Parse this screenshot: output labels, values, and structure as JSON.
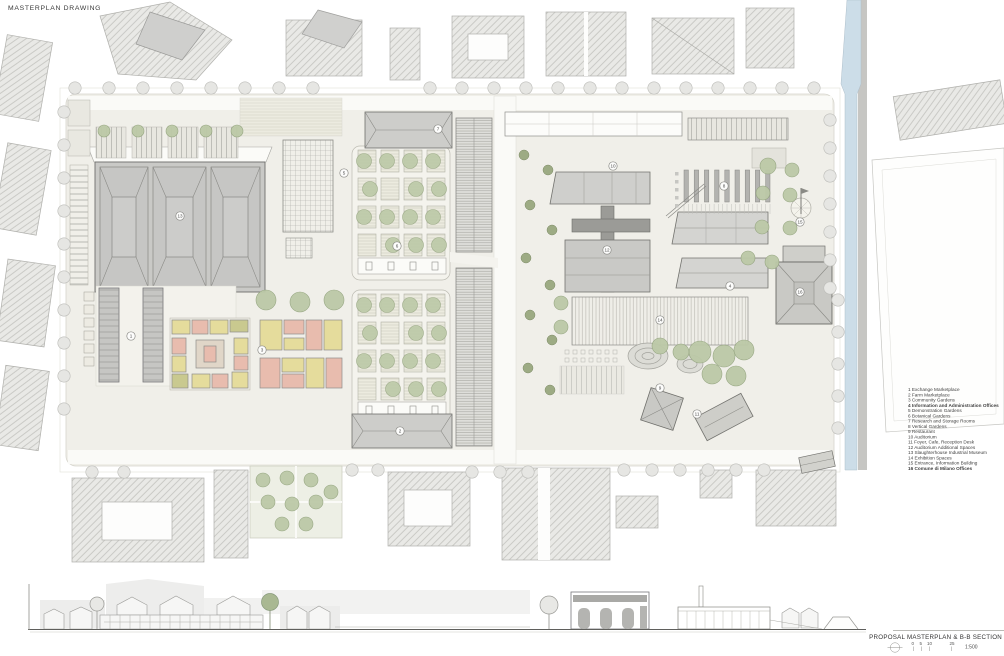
{
  "title": "MASTERPLAN DRAWING",
  "legend": {
    "items": [
      "1 Exchange Marketplace",
      "2 Farm Marketplace",
      "3 Community Gardens",
      "4 Information and Administration Offices",
      "5 Demonstration Gardens",
      "6 Botanical Gardens",
      "7 Research and Storage Rooms",
      "8 Vertical Gardens",
      "9 Restaurant",
      "10 Auditorium",
      "11 Foyer, Cafe, Reception Desk",
      "12 Auditorium Additional Spaces",
      "13 Slaughterhouse Industrial Museum",
      "14 Exhibition Spaces",
      "15 Entrance, Information Building",
      "16 Comune di Milano Offices"
    ]
  },
  "footer": {
    "caption": "PROPOSAL MASTERPLAN & B-B SECTION",
    "scale_ratio": "1:500",
    "scale_ticks": [
      "0",
      "5",
      "10",
      "25"
    ]
  },
  "plan": {
    "markers": [
      {
        "n": "1",
        "x": 131,
        "y": 336
      },
      {
        "n": "2",
        "x": 400,
        "y": 431
      },
      {
        "n": "3",
        "x": 262,
        "y": 350
      },
      {
        "n": "4",
        "x": 730,
        "y": 286
      },
      {
        "n": "5",
        "x": 344,
        "y": 173
      },
      {
        "n": "6",
        "x": 397,
        "y": 246
      },
      {
        "n": "7",
        "x": 438,
        "y": 129
      },
      {
        "n": "8",
        "x": 724,
        "y": 186
      },
      {
        "n": "9",
        "x": 660,
        "y": 388
      },
      {
        "n": "10",
        "x": 613,
        "y": 166
      },
      {
        "n": "11",
        "x": 697,
        "y": 414
      },
      {
        "n": "12",
        "x": 607,
        "y": 250
      },
      {
        "n": "13",
        "x": 180,
        "y": 216
      },
      {
        "n": "14",
        "x": 660,
        "y": 320
      },
      {
        "n": "15",
        "x": 800,
        "y": 222
      },
      {
        "n": "16",
        "x": 800,
        "y": 292
      }
    ]
  },
  "colors": {
    "site": "#f0efe9",
    "building": "#c9c9c6",
    "canal": "#ccdde8",
    "tree_green": "#bcc9a7",
    "tree_green_dark": "#9dab84",
    "tree_gray": "#e6e6e3",
    "room_yellow": "#e5dc9c",
    "room_pink": "#e8bcae",
    "room_olive": "#c9c98f"
  }
}
